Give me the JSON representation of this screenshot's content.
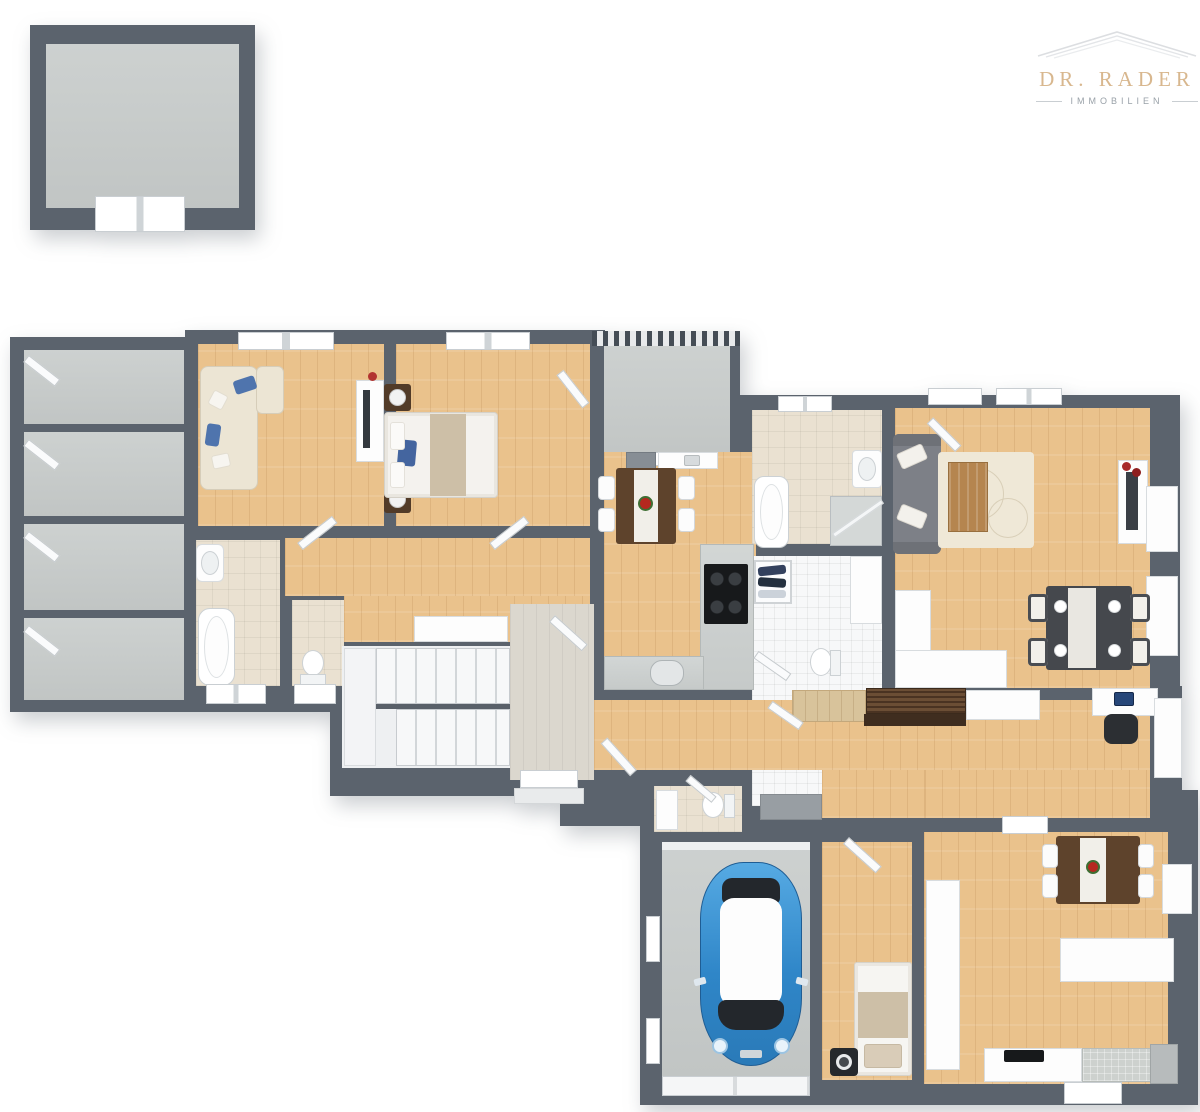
{
  "logo": {
    "name": "DR. RADER",
    "subtitle": "IMMOBILIEN"
  },
  "palette": {
    "wall": "#5b636d",
    "wood": "#eac28c",
    "concrete": "#c6cac9",
    "tile_beige": "#eae1d1",
    "tile_white": "#f7f8f9",
    "entry_tile": "#dbd7ce",
    "cream_sofa": "#ece5d4",
    "accent_blue": "#4f74ad",
    "sofa_gray": "#7d8087",
    "walnut": "#5e432c",
    "espresso": "#45484d",
    "car_blue": "#3490d8",
    "logo_gold": "#d8b78e",
    "logo_gray": "#99a1a8"
  },
  "floorplan": {
    "detached_building": [
      {
        "name": "storage-shed",
        "floor": "concrete",
        "furniture": [
          "double-door"
        ]
      }
    ],
    "main_building": [
      {
        "name": "storage-room-1",
        "floor": "concrete",
        "furniture": [
          "door"
        ]
      },
      {
        "name": "storage-room-2",
        "floor": "concrete",
        "furniture": [
          "door"
        ]
      },
      {
        "name": "storage-room-3",
        "floor": "concrete",
        "furniture": [
          "door"
        ]
      },
      {
        "name": "storage-room-4",
        "floor": "concrete",
        "furniture": [
          "door"
        ]
      },
      {
        "name": "living-room",
        "floor": "wood",
        "furniture": [
          "corner-sofa",
          "blue-pillows",
          "tv-sideboard",
          "window"
        ]
      },
      {
        "name": "bedroom",
        "floor": "wood",
        "furniture": [
          "double-bed",
          "nightstand-left",
          "nightstand-right",
          "lamps",
          "window"
        ]
      },
      {
        "name": "hallway",
        "floor": "wood",
        "furniture": [
          "sideboard",
          "doors"
        ]
      },
      {
        "name": "bathroom-1",
        "floor": "beige-tile",
        "furniture": [
          "washbasin",
          "bathtub",
          "window"
        ]
      },
      {
        "name": "wc-1",
        "floor": "beige-tile",
        "furniture": [
          "toilet",
          "window"
        ]
      },
      {
        "name": "staircase",
        "floor": "hard",
        "furniture": [
          "stair-flight-upper",
          "stair-flight-lower",
          "landing"
        ]
      },
      {
        "name": "entry-hall",
        "floor": "stone-tile",
        "furniture": [
          "front-door",
          "step"
        ]
      },
      {
        "name": "balcony",
        "floor": "concrete",
        "furniture": [
          "railing",
          "balcony-door"
        ]
      },
      {
        "name": "kitchen-dining",
        "floor": "wood",
        "furniture": [
          "dining-table",
          "4-chairs",
          "flowers",
          "cooktop-counter",
          "sink-counter",
          "tall-cabinet"
        ]
      },
      {
        "name": "bathroom-2",
        "floor": "beige-tile",
        "furniture": [
          "bathtub",
          "washbasin",
          "shower",
          "window"
        ]
      },
      {
        "name": "utility-room",
        "floor": "white-tile",
        "furniture": [
          "clothes-rack",
          "cabinet",
          "toilet"
        ]
      },
      {
        "name": "living-dining-room",
        "floor": "wood",
        "furniture": [
          "gray-sofa",
          "rug",
          "coffee-table",
          "tv-sideboard",
          "dining-table",
          "4-chairs",
          "kitchenette-counter",
          "wall-shelves",
          "windows"
        ]
      },
      {
        "name": "corridor",
        "floor": "wood",
        "furniture": [
          "wood-sideboard",
          "slatted-bench",
          "white-sideboard",
          "desk",
          "laptop",
          "office-chair",
          "wall-shelf",
          "locker"
        ]
      },
      {
        "name": "wc-2",
        "floor": "beige-tile",
        "furniture": [
          "toilet",
          "shelf"
        ]
      },
      {
        "name": "garage",
        "floor": "concrete",
        "furniture": [
          "blue-car",
          "garage-door",
          "windows"
        ]
      },
      {
        "name": "small-bedroom",
        "floor": "wood",
        "furniture": [
          "single-bed",
          "speaker"
        ]
      },
      {
        "name": "kitchen-living-room",
        "floor": "wood",
        "furniture": [
          "dining-table",
          "4-chairs",
          "flowers",
          "island-counter",
          "kitchen-counter",
          "cooktop",
          "fridge",
          "wall-shelves"
        ]
      }
    ]
  }
}
